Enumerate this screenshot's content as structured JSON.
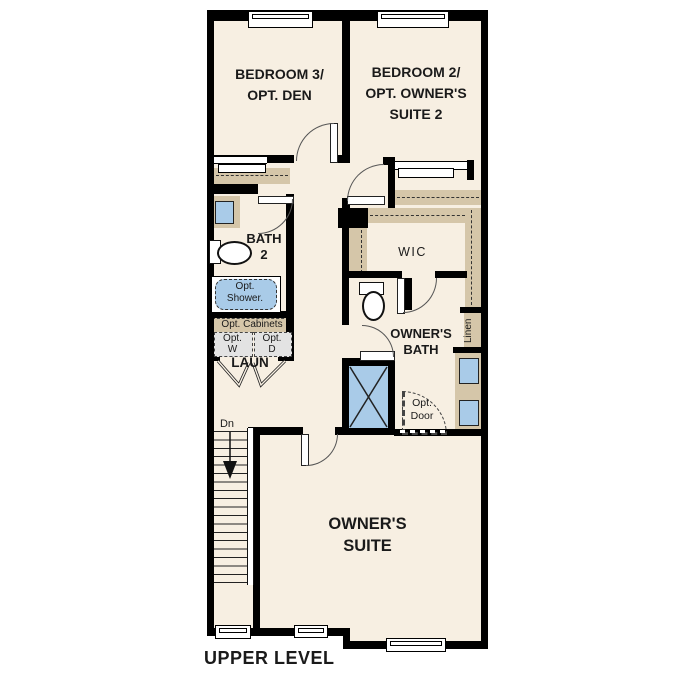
{
  "title": "UPPER LEVEL",
  "rooms": {
    "bedroom3": {
      "lines": [
        "BEDROOM 3/",
        "OPT. DEN"
      ]
    },
    "bedroom2": {
      "lines": [
        "BEDROOM 2/",
        "OPT. OWNER'S",
        "SUITE 2"
      ]
    },
    "bath2": {
      "lines": [
        "BATH",
        "2"
      ]
    },
    "wic": {
      "label": "WIC"
    },
    "owners_bath": {
      "lines": [
        "OWNER'S",
        "BATH"
      ]
    },
    "owners_suite": {
      "lines": [
        "OWNER'S",
        "SUITE"
      ]
    },
    "laundry": {
      "label": "LAUN"
    }
  },
  "annotations": {
    "opt_shower": {
      "lines": [
        "Opt.",
        "Shower."
      ]
    },
    "opt_cabinets": "Opt. Cabinets",
    "opt_washer": {
      "lines": [
        "Opt.",
        "W"
      ]
    },
    "opt_dryer": {
      "lines": [
        "Opt.",
        "D"
      ]
    },
    "opt_door": {
      "lines": [
        "Opt.",
        "Door"
      ]
    },
    "linen": "Linen",
    "stairs_down": "Dn"
  },
  "colors": {
    "floor": "#f7efe2",
    "wall": "#000000",
    "casework": "#d5c6a9",
    "fixture_blue": "#a9cbe8",
    "appliance_gray": "#e3e3e3",
    "text": "#1a1a1a"
  }
}
